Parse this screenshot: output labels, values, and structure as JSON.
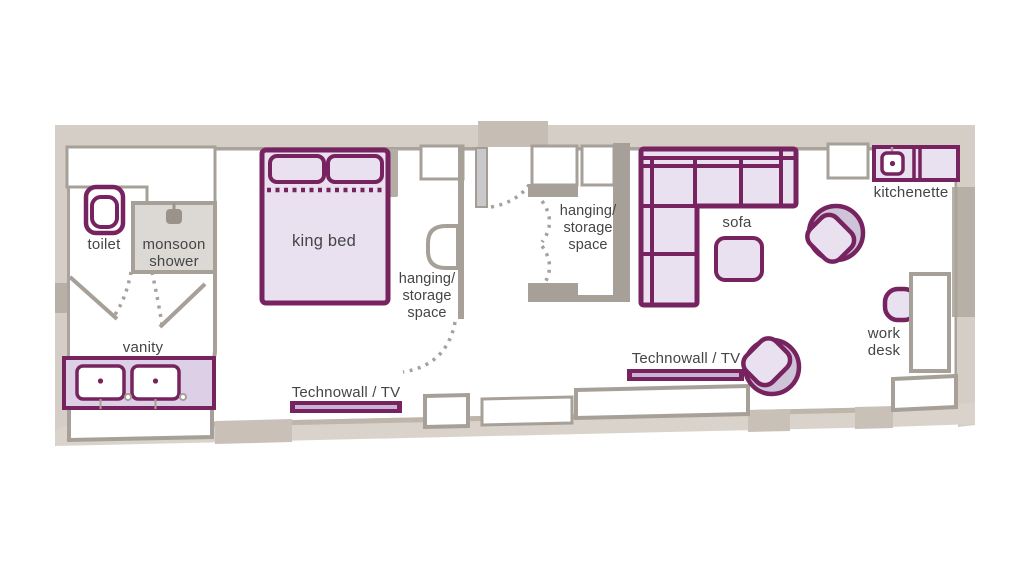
{
  "title": "hotel room floor plan",
  "palette": {
    "outer_wall": "#d5cec6",
    "outer_wall_dark": "#c7beb5",
    "wall_block_dark": "#b7b0a7",
    "inner_wall_gray": "#a6a098",
    "furniture_purple": "#76235f",
    "furniture_fill_lavender": "#e9e1f0",
    "chair_fill_mid_lavender": "#cfc3d9",
    "vanity_fill": "#ddd0e6",
    "shower_fill": "#dcd9d5",
    "door_panel": "#c9c9cb",
    "label_text": "#454547"
  },
  "labels": {
    "toilet": "toilet",
    "monsoon_shower": {
      "line1": "monsoon",
      "line2": "shower"
    },
    "vanity": "vanity",
    "king_bed": "king bed",
    "bedroom_storage": {
      "line1": "hanging/",
      "line2": "storage",
      "line3": "space"
    },
    "entry_storage": {
      "line1": "hanging/",
      "line2": "storage",
      "line3": "space"
    },
    "technowall_bedroom": "Technowall / TV",
    "technowall_living": "Technowall / TV",
    "sofa": "sofa",
    "kitchenette": "kitchenette",
    "work_desk": {
      "line1": "work",
      "line2": "desk"
    }
  },
  "fixtures": {
    "icons": [
      "toilet-icon",
      "shower-head-icon",
      "vanity-sink-icon",
      "kitchen-sink-icon",
      "door-swing-icon",
      "entry-door-icon",
      "tub-chair-icon",
      "desk-chair-icon"
    ],
    "furniture": [
      "king-bed",
      "sectional-sofa",
      "ottoman",
      "work-desk",
      "kitchenette-counter",
      "vanity-unit",
      "technowall-tv-unit"
    ]
  }
}
